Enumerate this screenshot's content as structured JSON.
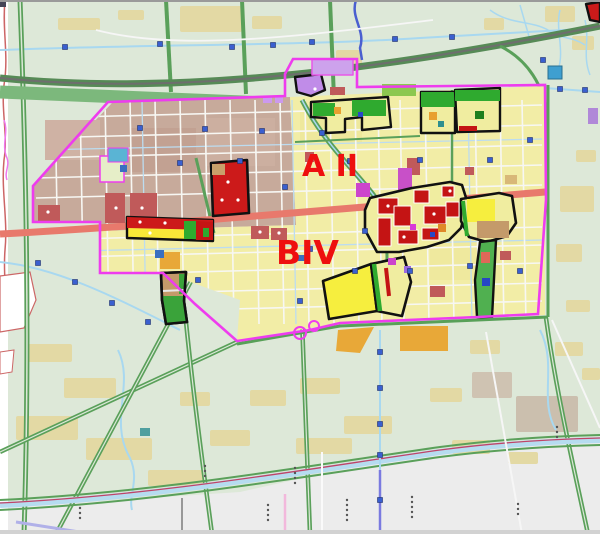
{
  "map": {
    "kind": "urban-planning-zoning-map",
    "labels": [
      {
        "id": "district-a2",
        "text": "A II"
      },
      {
        "id": "district-b4",
        "text": "BIV"
      }
    ],
    "label_color": "#ee0f0f",
    "palette": {
      "rural_bg": "#dde8d8",
      "outside_gray": "#ececec",
      "urban_yellow": "#f2eda6",
      "urban_brown": "#c7aa9b",
      "village_tan": "#e3d9a4",
      "green_road": "#5aa05a",
      "green_belt": "#7cb87c",
      "water_blue": "#a8d8f0",
      "boundary_magenta": "#ee3cee",
      "zone_outline": "#111111",
      "zone_red": "#c41414",
      "zone_green": "#2faa2f",
      "zone_bright_yellow": "#f6ee3e",
      "zone_brown": "#c49a6a",
      "zone_purple": "#c08ce8",
      "corridor_red": "#e8796c",
      "marker_blue": "#3a5fd0",
      "parcel_red": "#c05a5a",
      "parcel_orange": "#e8a838",
      "parcel_violet": "#c850c8",
      "grid_white": "#f7f7f3"
    },
    "markers_blue_squares": [
      [
        65,
        47
      ],
      [
        160,
        44
      ],
      [
        232,
        47
      ],
      [
        273,
        45
      ],
      [
        312,
        42
      ],
      [
        395,
        39
      ],
      [
        452,
        37
      ],
      [
        560,
        89
      ],
      [
        585,
        90
      ],
      [
        543,
        60
      ],
      [
        140,
        128
      ],
      [
        205,
        129
      ],
      [
        262,
        131
      ],
      [
        322,
        133
      ],
      [
        350,
        161
      ],
      [
        420,
        160
      ],
      [
        490,
        160
      ],
      [
        240,
        161
      ],
      [
        180,
        163
      ],
      [
        285,
        187
      ],
      [
        365,
        231
      ],
      [
        310,
        249
      ],
      [
        355,
        271
      ],
      [
        410,
        271
      ],
      [
        470,
        266
      ],
      [
        520,
        271
      ],
      [
        300,
        301
      ],
      [
        38,
        263
      ],
      [
        75,
        282
      ],
      [
        112,
        303
      ],
      [
        148,
        322
      ],
      [
        380,
        352
      ],
      [
        380,
        388
      ],
      [
        380,
        424
      ],
      [
        380,
        455
      ],
      [
        380,
        500
      ],
      [
        198,
        280
      ],
      [
        530,
        140
      ]
    ],
    "chainage_dot_clusters": [
      [
        268,
        505,
        4
      ],
      [
        295,
        468,
        4
      ],
      [
        347,
        500,
        5
      ],
      [
        412,
        497,
        5
      ],
      [
        518,
        504,
        3
      ],
      [
        557,
        427,
        3
      ],
      [
        80,
        508,
        3
      ],
      [
        205,
        466,
        3
      ]
    ],
    "road_grid": {
      "verticals": [
        55,
        80,
        105,
        130,
        155,
        180,
        205,
        230,
        255,
        280,
        305,
        330,
        355,
        378,
        400,
        425,
        450,
        475,
        500,
        522
      ],
      "horizontals": [
        118,
        138,
        158,
        178,
        198,
        240,
        258,
        276,
        296,
        314
      ],
      "water_verticals": [
        142,
        292,
        468
      ]
    }
  }
}
